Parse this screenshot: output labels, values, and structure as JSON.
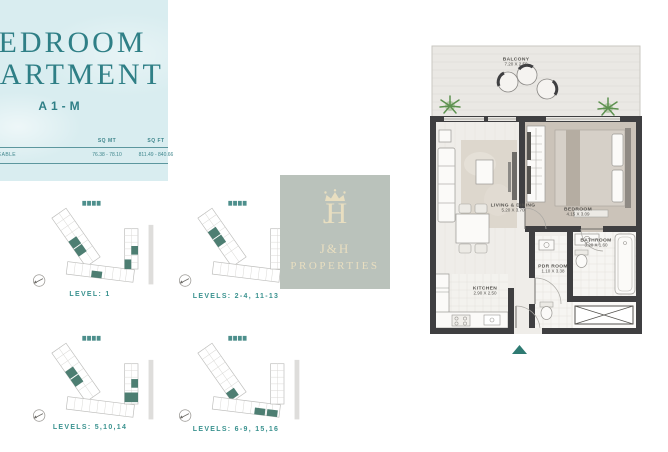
{
  "title_card": {
    "line1": "BEDROOM",
    "line2": "APARTMENT",
    "unit_code": "A1-M",
    "area_table": {
      "row_label": "SALEABLE",
      "col_sq_mt": "SQ MT",
      "col_sq_ft": "SQ FT",
      "sq_mt_value": "76.38 - 78.10",
      "sq_ft_value": "811.49 - 840.66"
    }
  },
  "logo": {
    "monogram_j": "J",
    "monogram_h": "H",
    "name_line1": "J&H",
    "name_line2": "PROPERTIES"
  },
  "level_plans": [
    {
      "label": "LEVEL: 1"
    },
    {
      "label": "LEVELS: 2-4, 11-13"
    },
    {
      "label": "LEVELS: 5,10,14"
    },
    {
      "label": "LEVELS: 6-9, 15,16"
    }
  ],
  "floorplan": {
    "rooms": [
      {
        "name": "BALCONY",
        "dims": "7.20 X 2.50"
      },
      {
        "name": "LIVING & DINING",
        "dims": "5.20 X 3.70"
      },
      {
        "name": "BEDROOM",
        "dims": "4.15 X 3.09"
      },
      {
        "name": "BATHROOM",
        "dims": "3.20 X 1.60"
      },
      {
        "name": "PDR ROOM",
        "dims": "1.10 X 3.38"
      },
      {
        "name": "KITCHEN",
        "dims": "2.90 X 2.50"
      }
    ]
  },
  "colors": {
    "title_teal": "#2f7f86",
    "card_bg": "#d9edf0",
    "plan_unit_teal": "#4d7e72",
    "plan_label_teal": "#3a928f",
    "logo_bg": "#bac2bb",
    "logo_text": "#e8dec0",
    "wall": "#3f3f41",
    "bedroom_floor": "#cbc3b9",
    "entry_marker": "#2e7a72"
  }
}
